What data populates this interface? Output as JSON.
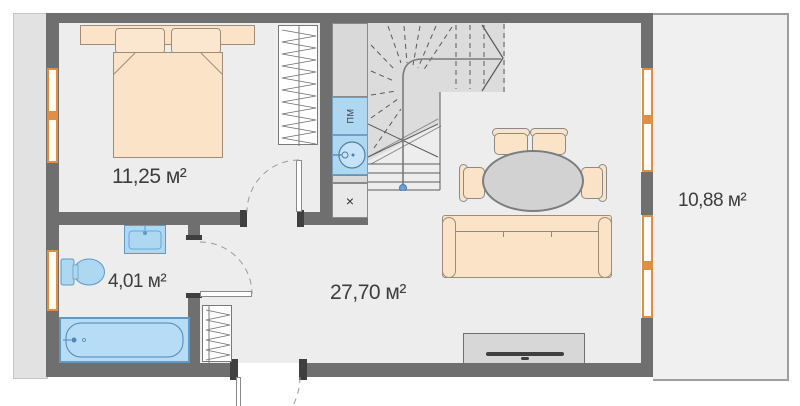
{
  "floor_plan": {
    "rooms": [
      {
        "id": "bedroom",
        "area_label": "11,25 м²"
      },
      {
        "id": "bathroom",
        "area_label": "4,01 м²"
      },
      {
        "id": "living_kitchen",
        "area_label": "27,70 м²"
      },
      {
        "id": "terrace",
        "area_label": "10,88 м²"
      }
    ],
    "kitchen": {
      "dishwasher_label": "ПМ",
      "hob_label": "×"
    },
    "colors": {
      "wall": "#6f6f6f",
      "floor": "#ededed",
      "furniture_peach": "#fae3c7",
      "fixture_blue": "#aed7f2",
      "window_frame_orange": "#e09045",
      "stairs_gray": "#dcdcdc",
      "handrail_dot_blue": "#6aa0d8"
    }
  }
}
